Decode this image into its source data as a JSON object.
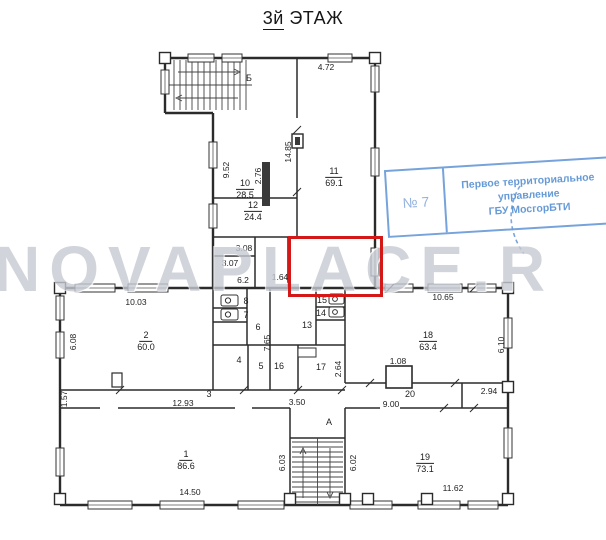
{
  "title": {
    "floor": "3й",
    "word": "ЭТАЖ"
  },
  "watermark": "NOVAPLACE.R",
  "stamp": {
    "number": "№ 7",
    "lines": [
      "Первое территориальное",
      "управление",
      "ГБУ МосгорБТИ"
    ],
    "color": "#5a92d4",
    "border_color": "#6b9cd8"
  },
  "highlight": {
    "x": 288,
    "y": 236,
    "w": 89,
    "h": 55,
    "color": "#d41717"
  },
  "colors": {
    "wall": "#2b2b2b",
    "paper": "#ffffff",
    "watermark_gray": "#c6cad3"
  },
  "room_labels": [
    {
      "num": "10",
      "area": "28.5",
      "x": 245,
      "y": 187
    },
    {
      "num": "12",
      "area": "24.4",
      "x": 253,
      "y": 209
    },
    {
      "num": "11",
      "area": "69.1",
      "x": 334,
      "y": 175
    },
    {
      "num": "2",
      "area": "60.0",
      "x": 146,
      "y": 339
    },
    {
      "num": "18",
      "area": "63.4",
      "x": 428,
      "y": 339
    },
    {
      "num": "1",
      "area": "86.6",
      "x": 186,
      "y": 458
    },
    {
      "num": "19",
      "area": "73.1",
      "x": 425,
      "y": 461
    }
  ],
  "plain_labels": [
    {
      "text": "Б",
      "x": 249,
      "y": 78
    },
    {
      "text": "8",
      "x": 246,
      "y": 301
    },
    {
      "text": "7",
      "x": 246,
      "y": 315
    },
    {
      "text": "6",
      "x": 258,
      "y": 327
    },
    {
      "text": "4",
      "x": 239,
      "y": 360
    },
    {
      "text": "5",
      "x": 261,
      "y": 366
    },
    {
      "text": "15",
      "x": 322,
      "y": 300
    },
    {
      "text": "14",
      "x": 321,
      "y": 313
    },
    {
      "text": "13",
      "x": 307,
      "y": 325
    },
    {
      "text": "16",
      "x": 279,
      "y": 366
    },
    {
      "text": "17",
      "x": 321,
      "y": 367
    },
    {
      "text": "3",
      "x": 209,
      "y": 394
    },
    {
      "text": "20",
      "x": 410,
      "y": 394
    },
    {
      "text": "А",
      "x": 329,
      "y": 422
    }
  ],
  "dim_labels": [
    {
      "text": "4.72",
      "x": 326,
      "y": 67,
      "v": false
    },
    {
      "text": "9.52",
      "x": 226,
      "y": 170,
      "v": true
    },
    {
      "text": "2.76",
      "x": 258,
      "y": 176,
      "v": true
    },
    {
      "text": "14.85",
      "x": 288,
      "y": 152,
      "v": true
    },
    {
      "text": "3.08",
      "x": 244,
      "y": 248,
      "v": false
    },
    {
      "text": "3.07",
      "x": 230,
      "y": 263,
      "v": false
    },
    {
      "text": "6.2",
      "x": 243,
      "y": 280,
      "v": false
    },
    {
      "text": "1.64",
      "x": 280,
      "y": 277,
      "v": false
    },
    {
      "text": "10.03",
      "x": 136,
      "y": 302,
      "v": false
    },
    {
      "text": "10.65",
      "x": 443,
      "y": 297,
      "v": false
    },
    {
      "text": "6.08",
      "x": 73,
      "y": 342,
      "v": true
    },
    {
      "text": "7.65",
      "x": 267,
      "y": 343,
      "v": true
    },
    {
      "text": "2.64",
      "x": 338,
      "y": 369,
      "v": true
    },
    {
      "text": "6.10",
      "x": 501,
      "y": 345,
      "v": true
    },
    {
      "text": "1.08",
      "x": 398,
      "y": 361,
      "v": false
    },
    {
      "text": "1.57",
      "x": 64,
      "y": 399,
      "v": true
    },
    {
      "text": "12.93",
      "x": 183,
      "y": 403,
      "v": false
    },
    {
      "text": "3.50",
      "x": 297,
      "y": 402,
      "v": false
    },
    {
      "text": "9.00",
      "x": 391,
      "y": 404,
      "v": false
    },
    {
      "text": "2.94",
      "x": 489,
      "y": 391,
      "v": false
    },
    {
      "text": "6.03",
      "x": 282,
      "y": 463,
      "v": true
    },
    {
      "text": "6.02",
      "x": 353,
      "y": 463,
      "v": true
    },
    {
      "text": "14.50",
      "x": 190,
      "y": 492,
      "v": false
    },
    {
      "text": "11.62",
      "x": 453,
      "y": 488,
      "v": false
    }
  ]
}
